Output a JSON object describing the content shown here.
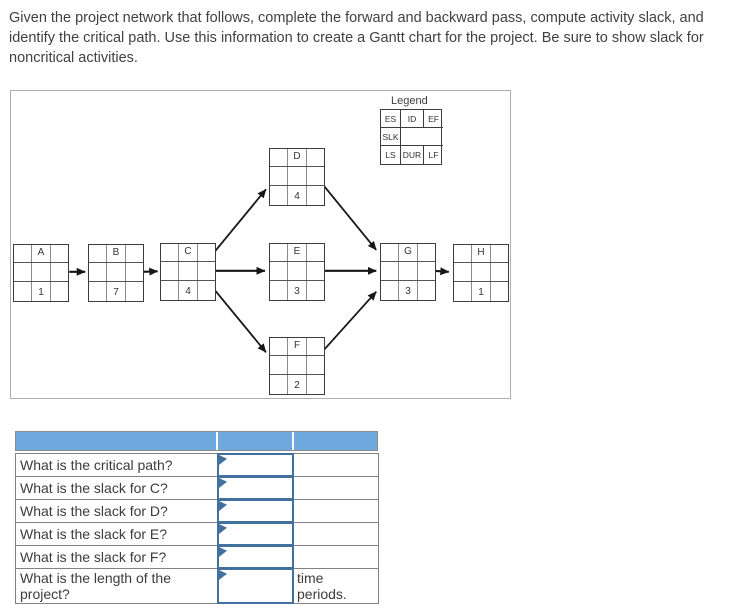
{
  "instructions": "Given the project network that follows, complete the forward and backward pass, compute activity slack, and identify the critical path. Use this information to create a Gantt chart for the project. Be sure to show slack for noncritical activities.",
  "network": {
    "legend": {
      "title": "Legend",
      "es": "ES",
      "id": "ID",
      "ef": "EF",
      "slk": "SLK",
      "ls": "LS",
      "dur": "DUR",
      "lf": "LF"
    },
    "nodes": [
      {
        "id": "A",
        "duration": "1"
      },
      {
        "id": "B",
        "duration": "7"
      },
      {
        "id": "C",
        "duration": "4"
      },
      {
        "id": "D",
        "duration": "4"
      },
      {
        "id": "E",
        "duration": "3"
      },
      {
        "id": "F",
        "duration": "2"
      },
      {
        "id": "G",
        "duration": "3"
      },
      {
        "id": "H",
        "duration": "1"
      }
    ],
    "edges": [
      "A→B",
      "B→C",
      "C→D",
      "C→E",
      "C→F",
      "D→G",
      "E→G",
      "F→G",
      "G→H"
    ]
  },
  "questions": {
    "rows": [
      {
        "label": "What is the critical path?",
        "answer": "",
        "note": ""
      },
      {
        "label": "What is the slack for C?",
        "answer": "",
        "note": ""
      },
      {
        "label": "What is the slack for D?",
        "answer": "",
        "note": ""
      },
      {
        "label": "What is the slack for E?",
        "answer": "",
        "note": ""
      },
      {
        "label": "What is the slack for F?",
        "answer": "",
        "note": ""
      },
      {
        "label": "What is the length of the project?",
        "answer": "",
        "note": "time periods."
      }
    ]
  },
  "colors": {
    "header_blue": "#6FA8DC",
    "answer_box_border": "#41719C",
    "table_border": "#828282",
    "panel_border": "#AEAEAE"
  }
}
